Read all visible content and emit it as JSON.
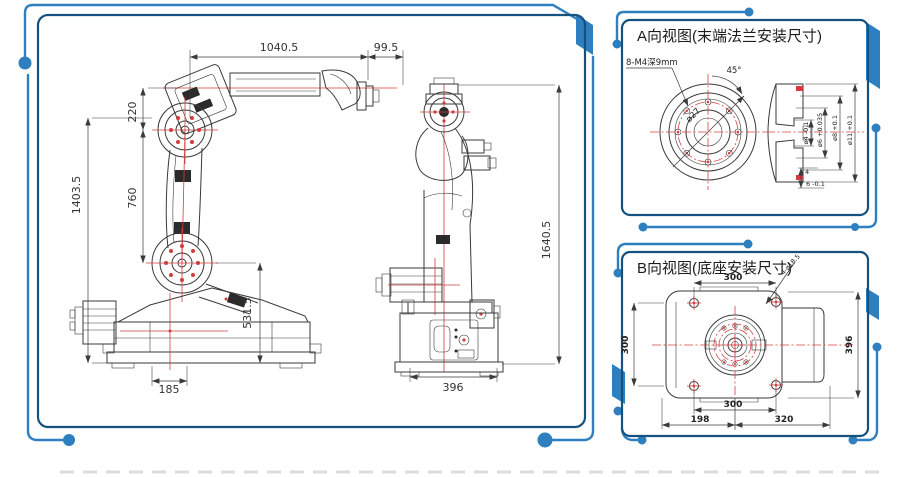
{
  "colors": {
    "accent_blue": "#2e7fc0",
    "panel_border": "#15517f",
    "drawing_line": "#3a3a3a",
    "centerline_red": "#d23c3c"
  },
  "main_panel": {
    "side_view": {
      "dim_arm_length": "1040.5",
      "dim_wrist_offset": "99.5",
      "dim_shoulder_drop": "220",
      "dim_lower_arm": "760",
      "dim_total_height": "1403.5",
      "dim_base_height": "531.5",
      "dim_base_width": "185"
    },
    "front_view": {
      "dim_total_height": "1640.5",
      "dim_base_width": "396"
    }
  },
  "panel_a": {
    "title": "A向视图(末端法兰安装尺寸)",
    "thread_note": "8-M4深9mm",
    "angle_label": "45°",
    "pitch_circle_label": "ø27",
    "section_dims": [
      "ø4 -0.1",
      "ø6 +0.035",
      "ø8 +0.1",
      "ø11 +0.1"
    ],
    "boss_width": "4",
    "boss_depth": "6 -0.1"
  },
  "panel_b": {
    "title": "B向视图(底座安装尺寸)",
    "hole_note": "4-ø18.5",
    "dim_top": "300",
    "dim_left": "300",
    "dim_right": "396",
    "dim_bottom": "300",
    "dim_bottom_left": "198",
    "dim_bottom_right": "320"
  }
}
